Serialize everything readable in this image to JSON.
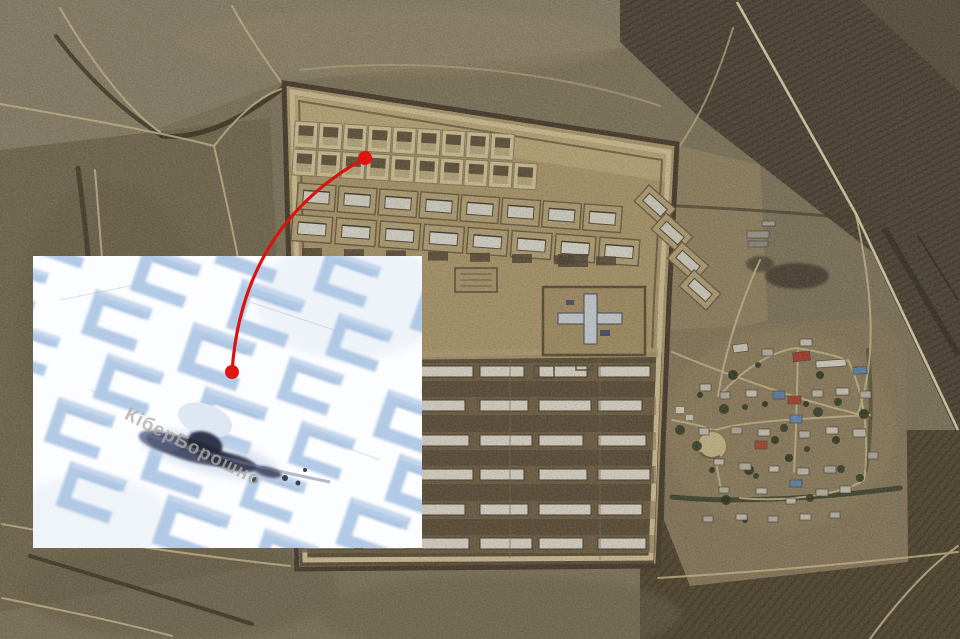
{
  "inset": {
    "watermark": "КіберБорошно",
    "watermark_color": "#b2ada3",
    "background": "#fcfdff",
    "berm_blue": "#a9c3e3",
    "debris_dark": "#3a4157"
  },
  "annotation": {
    "line_color": "#d81410",
    "marker_color": "#e01511"
  },
  "palette": {
    "terrain_base": "#7f745a",
    "fields_dark": "#4e4434",
    "compound_upper": "#ab9668",
    "compound_lower": "#5b4d37",
    "perimeter_road": "#cfbf92",
    "warehouse_roof": "#ddd7c8",
    "road": "#c7b689",
    "highway": "#decfa6",
    "railway": "#362f26"
  }
}
